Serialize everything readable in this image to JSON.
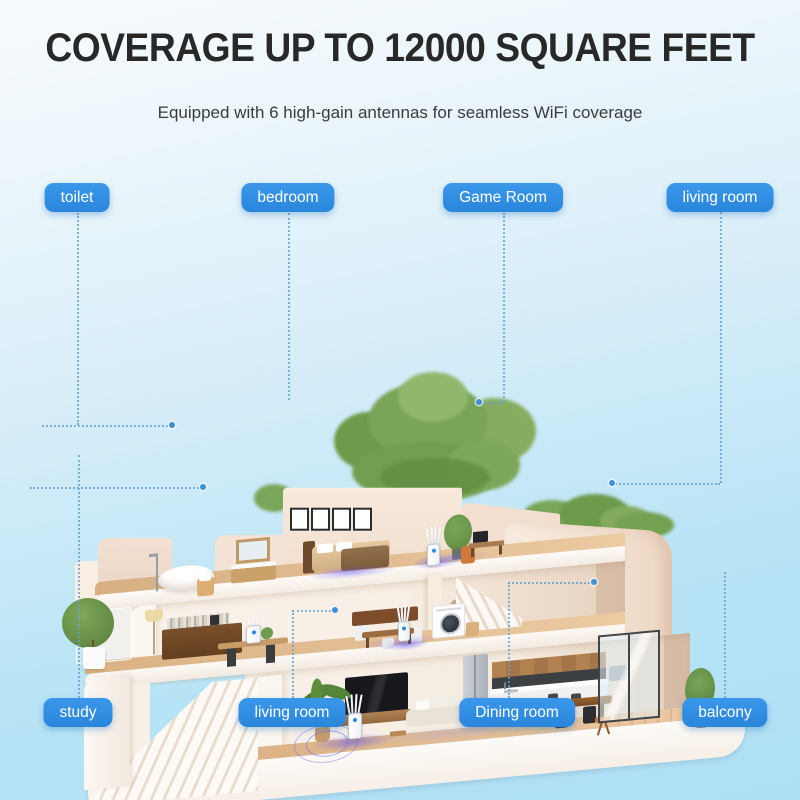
{
  "header": {
    "title": "COVERAGE UP TO 12000 SQUARE FEET",
    "subtitle": "Equipped with 6 high-gain antennas for seamless WiFi coverage"
  },
  "room_labels": {
    "top": [
      {
        "text": "toilet"
      },
      {
        "text": "bedroom"
      },
      {
        "text": "Game Room"
      },
      {
        "text": "living room"
      }
    ],
    "bottom": [
      {
        "text": "study"
      },
      {
        "text": "living room"
      },
      {
        "text": "Dining room"
      },
      {
        "text": "balcony"
      }
    ]
  },
  "colors": {
    "label_background": "#2F8EE4",
    "label_text": "#FFFFFF",
    "connector": "#64A0D7",
    "wifi_glow": "#6A5DF0",
    "sky_top": "#F6FAFD",
    "sky_bottom": "#ABDFF5",
    "title_text": "#282828"
  }
}
